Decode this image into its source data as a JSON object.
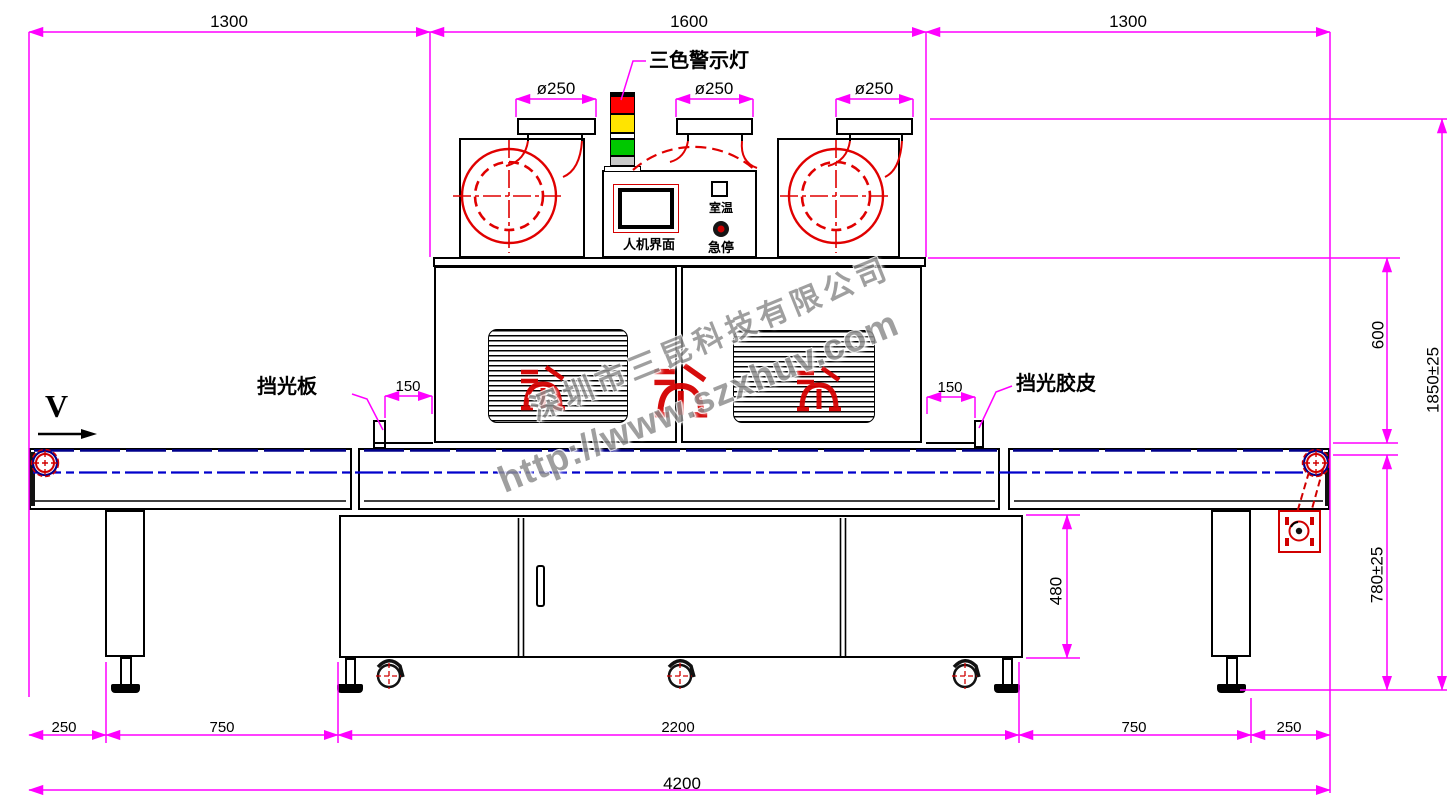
{
  "dimensions": {
    "top": [
      "1300",
      "1600",
      "1300"
    ],
    "duct_diameters": [
      "ø250",
      "ø250",
      "ø250"
    ],
    "right": {
      "oven_height": "600",
      "total_height": "1850±25",
      "table_height": "780±25"
    },
    "cabinet_height": "480",
    "offsets": {
      "left": "150",
      "right": "150"
    },
    "bottom": [
      "250",
      "750",
      "2200",
      "750",
      "250"
    ],
    "total_width": "4200"
  },
  "labels": {
    "warning_light": "三色警示灯",
    "hmi": "人机界面",
    "room_temp": "室温",
    "emergency_stop": "急停",
    "light_shield_plate": "挡光板",
    "light_shield_rubber": "挡光胶皮",
    "belt_direction": "V"
  },
  "watermark": {
    "company": "深圳市三昆科技有限公司",
    "website": "http://www.szxhuv.com"
  },
  "colors": {
    "dimension_magenta": "#FF00FF",
    "outline_black": "#000000",
    "accent_red": "#DD0000",
    "belt_navy": "#00008B",
    "belt_blue": "#0000CC",
    "light_red": "#FF0000",
    "light_yellow": "#FFE400",
    "light_green": "#00C800"
  }
}
